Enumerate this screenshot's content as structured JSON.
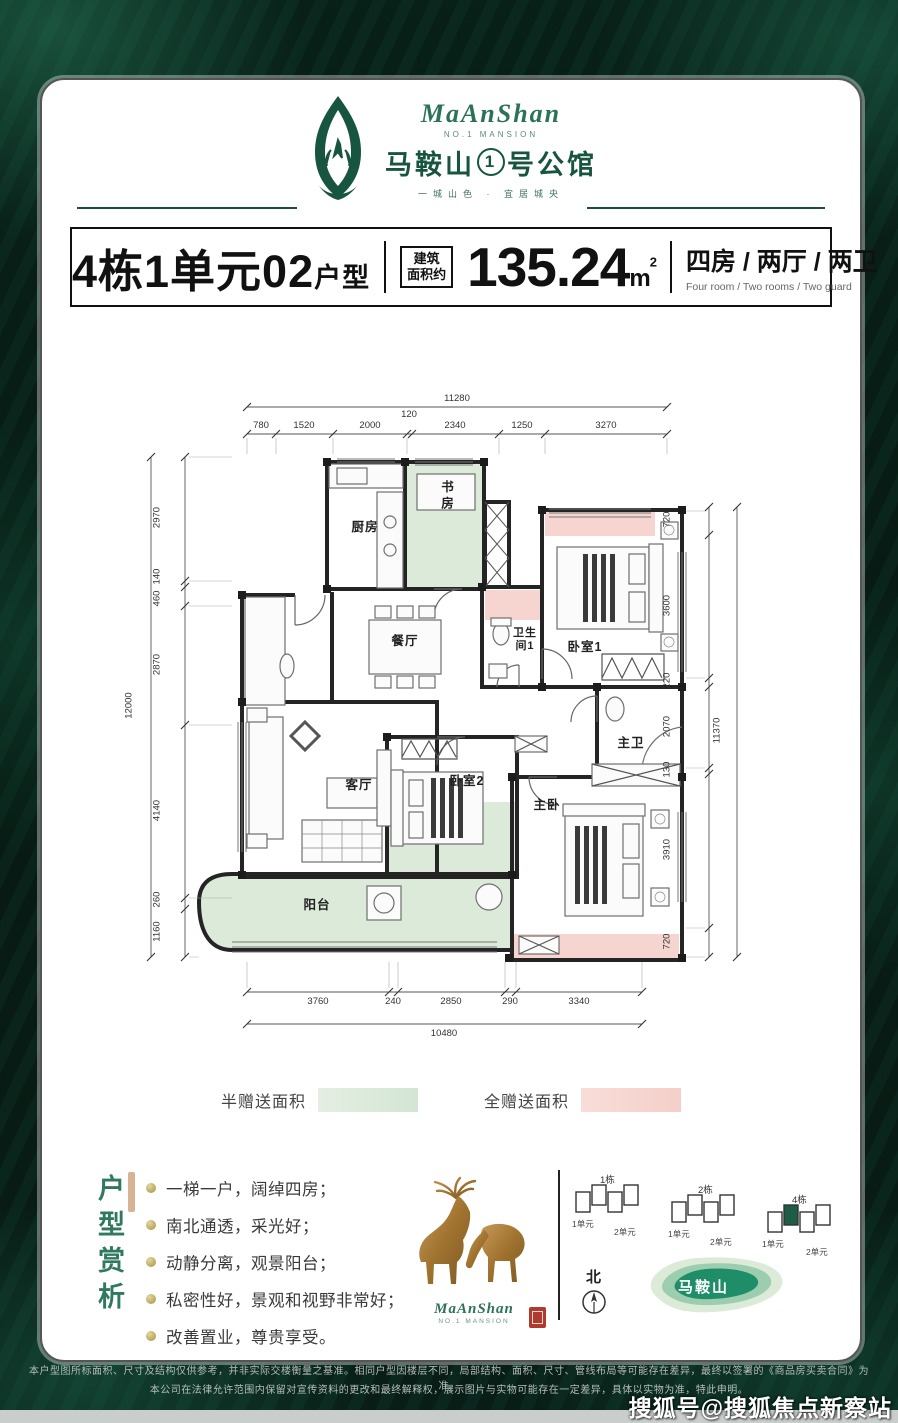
{
  "header": {
    "brand_script": "MaAnShan",
    "brand_sub": "NO.1 MANSION",
    "brand_cn_left": "马鞍山",
    "brand_cn_num": "1",
    "brand_cn_right": "号公馆",
    "brand_tagline": "一城山色 · 宜居城央"
  },
  "title_bar": {
    "unit_title": "4栋1单元02",
    "unit_suffix": "户型",
    "area_label_1": "建筑",
    "area_label_2": "面积约",
    "area_value": "135.24",
    "area_unit": "m",
    "area_unit_sup": "2",
    "rooms_cn": "四房 / 两厅 / 两卫",
    "rooms_en": "Four room / Two rooms / Two guard"
  },
  "floorplan": {
    "rooms": {
      "kitchen": "厨房",
      "study": "书房",
      "dining": "餐厅",
      "bath1": "卫生间1",
      "bed1": "卧室1",
      "master_bath": "主卫",
      "living": "客厅",
      "bed2": "卧室2",
      "master": "主卧",
      "balcony": "阳台"
    },
    "dims_top": {
      "total": "11280",
      "segments": [
        "780",
        "1520",
        "2000",
        "120",
        "2340",
        "1250",
        "3270"
      ]
    },
    "dims_bottom": {
      "total": "10480",
      "segments": [
        "3760",
        "240",
        "2850",
        "290",
        "3340"
      ]
    },
    "dims_left": {
      "total": "12000",
      "segments": [
        "2970",
        "140",
        "460",
        "2870",
        "4140",
        "260",
        "1160"
      ]
    },
    "dims_right": {
      "total": "11370",
      "segments": [
        "720",
        "3600",
        "220",
        "2070",
        "130",
        "3910",
        "720"
      ]
    },
    "colors": {
      "half_gift": "#dcead9",
      "full_gift": "#f6d5d1"
    }
  },
  "legend": {
    "half_label": "半赠送面积",
    "full_label": "全赠送面积"
  },
  "analysis": {
    "title": "户型赏析",
    "bullets": [
      "一梯一户，阔绰四房；",
      "南北通透，采光好；",
      "动静分离，观景阳台；",
      "私密性好，景观和视野非常好；",
      "改善置业，尊贵享受。"
    ]
  },
  "deer": {
    "brand_script": "MaAnShan",
    "brand_sub": "NO.1 MANSION"
  },
  "siteplan": {
    "buildings": [
      {
        "name": "1栋",
        "units": [
          "1单元",
          "2单元"
        ]
      },
      {
        "name": "2栋",
        "units": [
          "1单元",
          "2单元"
        ]
      },
      {
        "name": "4栋",
        "units": [
          "1单元",
          "2单元"
        ]
      }
    ],
    "compass_label": "北",
    "mountain_label": "马鞍山"
  },
  "disclaimer": {
    "line1": "本户型图所标面积、尺寸及结构仅供参考，并非实际交楼衡量之基准。相同户型因楼层不同，局部结构、面积、尺寸、管线布局等可能存在差异，最终以签署的《商品房买卖合同》为准。",
    "line2": "本公司在法律允许范围内保留对宣传资料的更改和最终解释权，展示图片与实物可能存在一定差异，具体以实物为准，特此申明。"
  },
  "watermark": {
    "text": "搜狐号@搜狐焦点新察站"
  },
  "colors": {
    "accent_green": "#175541",
    "deep_bg": "#0a241b"
  }
}
